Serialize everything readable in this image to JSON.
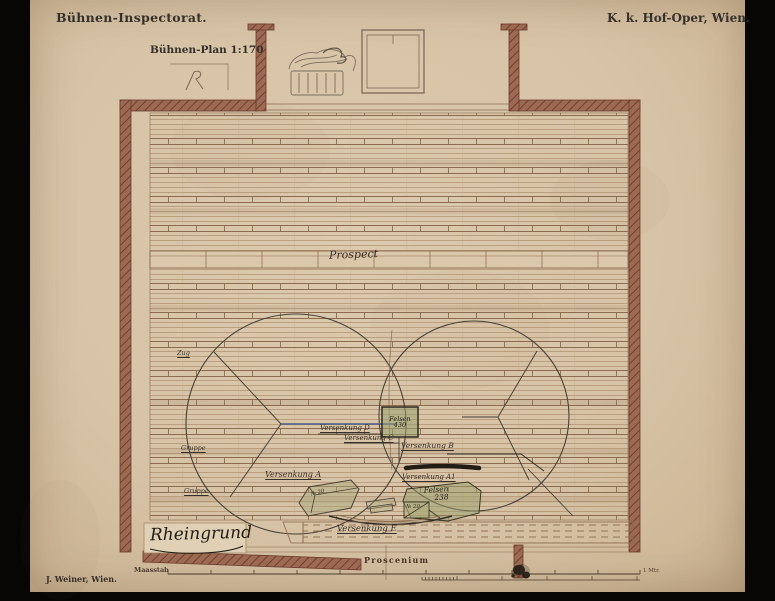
{
  "header": {
    "office": "Bühnen-Inspectorat.",
    "institution": "K. k. Hof-Oper, Wien.",
    "plan_title": "Bühnen-Plan 1:170"
  },
  "plan": {
    "backdrop_label": "Prospect",
    "scene_name": "Rheingrund",
    "proscenium": "Proscenium",
    "versenkung_a": "Versenkung A",
    "versenkung_a1": "Versenkung A1",
    "versenkung_b": "Versenkung B",
    "versenkung_c": "Versenkung C",
    "versenkung_d": "Versenkung D",
    "versenkung_e": "Versenkung E",
    "felsen_upper": {
      "label": "Felsen",
      "number": "430"
    },
    "felsen_lower": {
      "label": "Felsen",
      "number": "238"
    },
    "piece_no_box": "№ 20",
    "piece_no_block": "№ 20",
    "side_notes": [
      "Zug",
      "Gruppe",
      "Gruppe"
    ]
  },
  "footer": {
    "printer": "J. Weiner, Wien.",
    "scale_label": "Maasstab",
    "scale_end": "1 Mtr."
  },
  "colors": {
    "paper": "#d9c5a8",
    "wall": "#9c6a52",
    "wall_hatch": "#73402f",
    "ink": "#35302a",
    "line_brown": "#8d6b4e",
    "green_tint": "#98a06e",
    "blue_line": "#4a5a86"
  }
}
